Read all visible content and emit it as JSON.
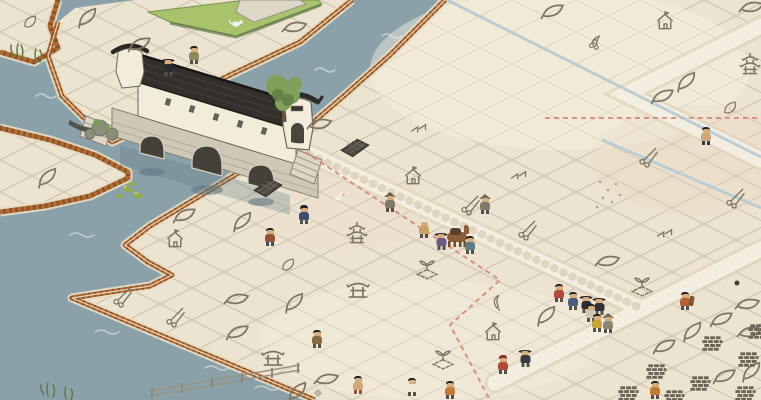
{
  "scene": {
    "description": "isometric watercolor canal town with covered stone bridge",
    "visible_text": []
  },
  "colors": {
    "water": "#8ba1aa",
    "wave": "#ccd8d8",
    "land": "#ece3d0",
    "grid_line": "#9a9080",
    "torn_edge": "#b06a33",
    "torn_edge_dark": "#7e4a20",
    "sand": "#e7ddc6",
    "road": "#f3eee0",
    "road_edge": "#e0d5bc",
    "icon_ink": "#7c7465",
    "roof": "#33302b",
    "bridge_wall": "#f2ecdb",
    "stone": "#cfc8b6",
    "grass": "#a9c36c",
    "tree": "#7fa058",
    "route_red": "#d4837a",
    "stream_blue": "#b2c9d0",
    "brick_ink": "#6b6356",
    "skin": "#d8ad7c",
    "hair": "#26211d"
  },
  "icons": [
    {
      "t": "leaf",
      "x": 88,
      "y": 18
    },
    {
      "t": "leaf",
      "x": 140,
      "y": 45
    },
    {
      "t": "leaf",
      "x": 295,
      "y": 28
    },
    {
      "t": "leaf",
      "x": 48,
      "y": 178
    },
    {
      "t": "leaf",
      "x": 553,
      "y": 12
    },
    {
      "t": "leaf",
      "x": 752,
      "y": 8
    },
    {
      "t": "leaf",
      "x": 687,
      "y": 82
    },
    {
      "t": "leaf",
      "x": 663,
      "y": 97
    },
    {
      "t": "leaf",
      "x": 320,
      "y": 125
    },
    {
      "t": "leaf",
      "x": 243,
      "y": 222
    },
    {
      "t": "leaf",
      "x": 185,
      "y": 216
    },
    {
      "t": "leaf",
      "x": 608,
      "y": 262
    },
    {
      "t": "leaf",
      "x": 547,
      "y": 316
    },
    {
      "t": "leaf",
      "x": 722,
      "y": 320
    },
    {
      "t": "leaf",
      "x": 748,
      "y": 305
    },
    {
      "t": "leaf",
      "x": 693,
      "y": 332
    },
    {
      "t": "leaf",
      "x": 665,
      "y": 347
    },
    {
      "t": "leaf",
      "x": 750,
      "y": 333
    },
    {
      "t": "leaf",
      "x": 752,
      "y": 372
    },
    {
      "t": "leaf",
      "x": 725,
      "y": 377
    },
    {
      "t": "leaf",
      "x": 237,
      "y": 300
    },
    {
      "t": "leaf",
      "x": 295,
      "y": 303
    },
    {
      "t": "leaf",
      "x": 238,
      "y": 333
    },
    {
      "t": "leaf",
      "x": 327,
      "y": 380
    },
    {
      "t": "leaf",
      "x": 298,
      "y": 392
    },
    {
      "t": "scissors",
      "x": 122,
      "y": 297
    },
    {
      "t": "scissors",
      "x": 175,
      "y": 317
    },
    {
      "t": "scissors",
      "x": 470,
      "y": 205
    },
    {
      "t": "scissors",
      "x": 527,
      "y": 230
    },
    {
      "t": "scissors",
      "x": 648,
      "y": 157
    },
    {
      "t": "scissors",
      "x": 735,
      "y": 198
    },
    {
      "t": "house",
      "x": 413,
      "y": 177
    },
    {
      "t": "house",
      "x": 665,
      "y": 22
    },
    {
      "t": "house",
      "x": 175,
      "y": 240
    },
    {
      "t": "house",
      "x": 493,
      "y": 333
    },
    {
      "t": "shrine",
      "x": 273,
      "y": 358
    },
    {
      "t": "shrine",
      "x": 358,
      "y": 290
    },
    {
      "t": "pagoda",
      "x": 357,
      "y": 234
    },
    {
      "t": "pagoda",
      "x": 750,
      "y": 65
    },
    {
      "t": "bell",
      "x": 730,
      "y": 108
    },
    {
      "t": "bell",
      "x": 288,
      "y": 265
    },
    {
      "t": "bell",
      "x": 30,
      "y": 22
    },
    {
      "t": "plot",
      "x": 427,
      "y": 268
    },
    {
      "t": "plot",
      "x": 642,
      "y": 285
    },
    {
      "t": "plot",
      "x": 443,
      "y": 358
    },
    {
      "t": "darkplot",
      "x": 268,
      "y": 188
    },
    {
      "t": "darkplot",
      "x": 355,
      "y": 148
    },
    {
      "t": "rake",
      "x": 519,
      "y": 175
    },
    {
      "t": "rake",
      "x": 419,
      "y": 128
    },
    {
      "t": "rake",
      "x": 665,
      "y": 233
    },
    {
      "t": "hook",
      "x": 498,
      "y": 302
    },
    {
      "t": "bricks",
      "x": 712,
      "y": 344
    },
    {
      "t": "bricks",
      "x": 656,
      "y": 372
    },
    {
      "t": "bricks",
      "x": 700,
      "y": 384
    },
    {
      "t": "bricks",
      "x": 748,
      "y": 360
    },
    {
      "t": "bricks",
      "x": 628,
      "y": 394
    },
    {
      "t": "bricks",
      "x": 674,
      "y": 398
    },
    {
      "t": "bricks",
      "x": 745,
      "y": 394
    },
    {
      "t": "bricks",
      "x": 758,
      "y": 332
    },
    {
      "t": "berries",
      "x": 595,
      "y": 43
    },
    {
      "t": "flower",
      "x": 318,
      "y": 393
    }
  ],
  "characters": [
    {
      "x": 168,
      "y": 76,
      "shirt": "#2e2c31",
      "hatType": "wide",
      "hat": "#1d1c20"
    },
    {
      "x": 194,
      "y": 64,
      "shirt": "#8a8a55",
      "hatType": "none"
    },
    {
      "x": 304,
      "y": 224,
      "shirt": "#3e4f6b",
      "hatType": "bun",
      "hat": "#23222a"
    },
    {
      "x": 270,
      "y": 246,
      "shirt": "#94503a",
      "pants": "#3c4c68",
      "hatType": "none"
    },
    {
      "x": 390,
      "y": 212,
      "shirt": "#7d7868",
      "hatType": "cone",
      "hat": "#66614e"
    },
    {
      "x": 485,
      "y": 214,
      "shirt": "#7f7a6a",
      "hatType": "cone",
      "hat": "#6e6955"
    },
    {
      "x": 424,
      "y": 238,
      "shirt": "#c7a161",
      "hatType": "dome",
      "hat": "#ece7d7"
    },
    {
      "x": 441,
      "y": 250,
      "shirt": "#6b5b84",
      "hatType": "wide",
      "hat": "#2c2a33"
    },
    {
      "x": 470,
      "y": 254,
      "shirt": "#5d7a87",
      "hatType": "none"
    },
    {
      "x": 559,
      "y": 302,
      "shirt": "#b14a39",
      "hatType": "none"
    },
    {
      "x": 573,
      "y": 310,
      "shirt": "#4a5f7f",
      "hatType": "none"
    },
    {
      "x": 586,
      "y": 313,
      "shirt": "#2f2c34",
      "hatType": "wide",
      "hat": "#1f1e24"
    },
    {
      "x": 599,
      "y": 315,
      "shirt": "#343039",
      "hatType": "wide",
      "hat": "#232127"
    },
    {
      "x": 591,
      "y": 322,
      "shirt": "#cfc8b9",
      "hatType": "none"
    },
    {
      "x": 597,
      "y": 332,
      "shirt": "#c9a43e",
      "hatType": "none"
    },
    {
      "x": 608,
      "y": 333,
      "shirt": "#8a8475",
      "hatType": "cone",
      "hat": "#6e6959"
    },
    {
      "x": 685,
      "y": 310,
      "shirt": "#b5603a",
      "hatType": "none",
      "pack": "#7a5a36"
    },
    {
      "x": 706,
      "y": 145,
      "shirt": "#d2a878",
      "pants": "#3a3a40",
      "hatType": "none"
    },
    {
      "x": 317,
      "y": 348,
      "shirt": "#8a6a42",
      "hatType": "none"
    },
    {
      "x": 358,
      "y": 394,
      "shirt": "#d2a878",
      "pants": "#94503a",
      "hatType": "none"
    },
    {
      "x": 412,
      "y": 396,
      "shirt": "#eee8da",
      "hatType": "none"
    },
    {
      "x": 450,
      "y": 399,
      "shirt": "#c07a3a",
      "hatType": "none"
    },
    {
      "x": 503,
      "y": 374,
      "shirt": "#b14a39",
      "hatType": "bun",
      "hat": "#8a2f26"
    },
    {
      "x": 525,
      "y": 367,
      "shirt": "#3a3a42",
      "hatType": "wide",
      "hat": "#26242a"
    },
    {
      "x": 655,
      "y": 399,
      "shirt": "#c07a3a",
      "hatType": "none"
    }
  ],
  "camel": {
    "x": 458,
    "y": 248,
    "body": "#8a5f38",
    "pack": "#59402a",
    "legs": "#6e4a2c"
  },
  "routes": [
    {
      "name": "trade-route",
      "color": "#d4837a",
      "width": 2,
      "dash": "5 4",
      "points": [
        [
          305,
          152
        ],
        [
          500,
          280
        ],
        [
          450,
          325
        ],
        [
          490,
          400
        ]
      ]
    },
    {
      "name": "trade-route",
      "color": "#d4837a",
      "width": 2,
      "dash": "5 4",
      "points": [
        [
          545,
          118
        ],
        [
          761,
          118
        ]
      ]
    },
    {
      "name": "stream",
      "color": "#b2c9d0",
      "width": 3,
      "dash": "",
      "points": [
        [
          447,
          0
        ],
        [
          761,
          157
        ]
      ]
    },
    {
      "name": "stream",
      "color": "#b2c9d0",
      "width": 3,
      "dash": "",
      "points": [
        [
          602,
          140
        ],
        [
          761,
          208
        ]
      ]
    }
  ]
}
